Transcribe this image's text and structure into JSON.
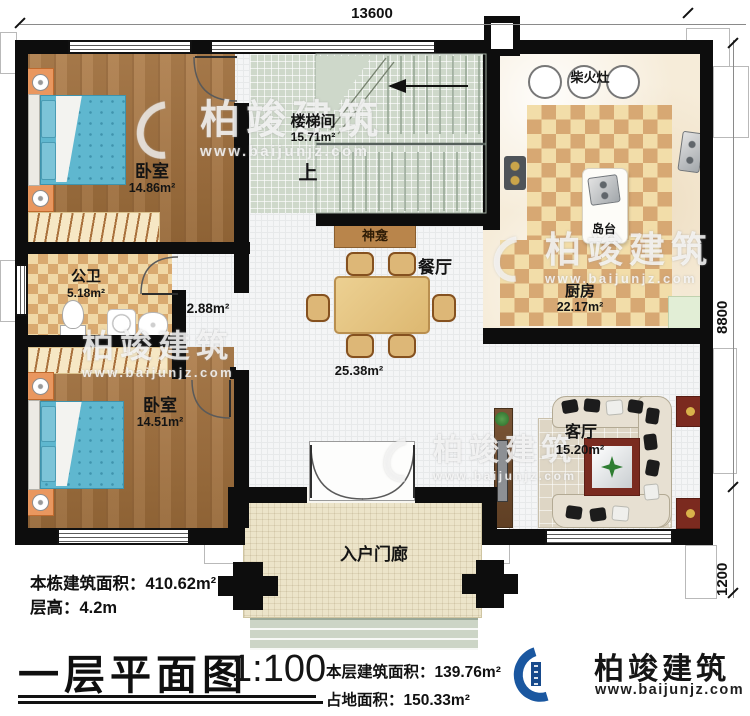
{
  "plan": {
    "dims": {
      "top": "13600",
      "side_main": "8800",
      "side_porch": "1200"
    },
    "rooms": {
      "bedroom1": {
        "label": "卧室",
        "area": "14.86m²"
      },
      "stair": {
        "label": "楼梯间",
        "area": "15.71m²",
        "up": "上"
      },
      "kitchen": {
        "label": "厨房",
        "area": "22.17m²",
        "stove": "柴火灶",
        "island": "岛台"
      },
      "bath": {
        "label": "公卫",
        "area": "5.18m²"
      },
      "hall": {
        "area": "2.88m²"
      },
      "bedroom2": {
        "label": "卧室",
        "area": "14.51m²"
      },
      "dining": {
        "label": "餐厅",
        "area": "25.38m²",
        "shrine": "神龛"
      },
      "living": {
        "label": "客厅",
        "area": "15.20m²"
      },
      "porch": {
        "label": "入户门廊"
      }
    }
  },
  "info": {
    "building_area_label": "本栋建筑面积：",
    "building_area_value": "410.62m²",
    "floor_height_label": "层高：",
    "floor_height_value": "4.2m",
    "title": "一层平面图",
    "scale": "1:100",
    "floor_area_label": "本层建筑面积：",
    "floor_area_value": "139.76m²",
    "footprint_label": "占地面积：",
    "footprint_value": "150.33m²"
  },
  "brand": {
    "name": "柏竣建筑",
    "site": "www.baijunjz.com"
  },
  "watermark": {
    "name": "柏竣建筑",
    "site": "www.baijunjz.com"
  }
}
